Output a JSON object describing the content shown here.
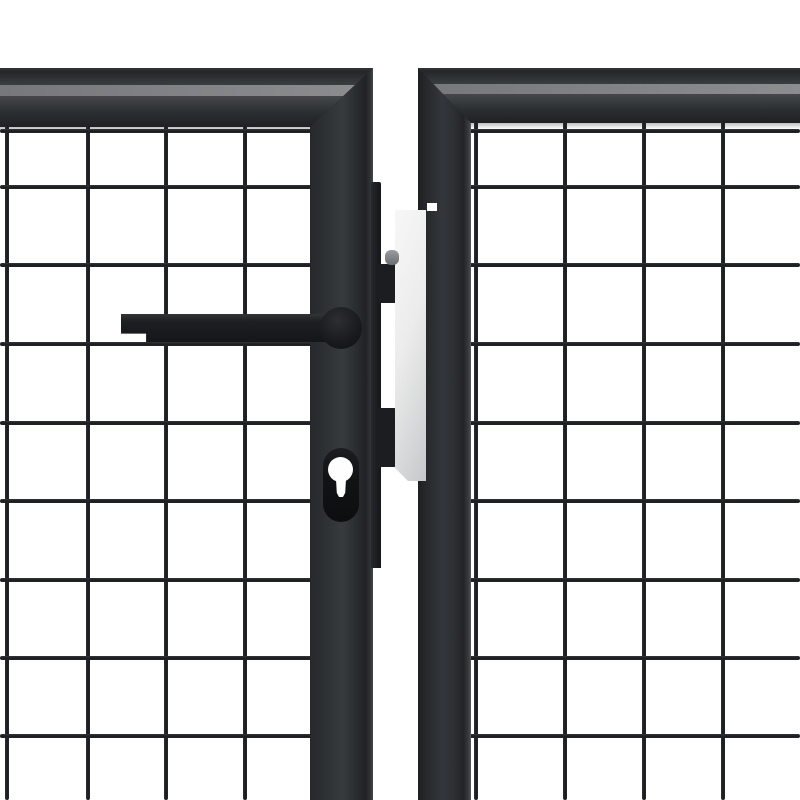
{
  "scene": {
    "description": "Product photograph of an anthracite steel mesh garden gate, close-up of the double-door centre with lever handle, euro-cylinder keyhole, latch hardware and galvanized strike plate on a white background",
    "background_color": "#ffffff",
    "width": 800,
    "height": 800
  },
  "colors": {
    "background": "#ffffff",
    "frame_dark": "#222427",
    "frame_mid": "#2e3134",
    "frame_bevel_light": "#85878a",
    "wire_dark": "#1e2124",
    "hardware_black": "#15171a",
    "plate_light": "#f6f6f6",
    "plate_dark": "#c7c8c9",
    "bolt_gray": "#8b8e90"
  },
  "panels": {
    "left": {
      "rail": {
        "x": 0,
        "y": 68,
        "w": 373,
        "h": 59
      },
      "rail_shadow": {
        "x": 0,
        "y": 127,
        "w": 314,
        "h": 6
      },
      "stile": {
        "x": 310,
        "y": 68,
        "w": 63,
        "h": 732
      },
      "mesh": {
        "wire_px": 4.5,
        "vertical_x": [
          7,
          88,
          166,
          245
        ],
        "horizontal_y": [
          131,
          187,
          265,
          344,
          423,
          501,
          580,
          658,
          736
        ],
        "h_x0": 0,
        "h_x1": 314,
        "v_y0": 125,
        "v_y1": 800
      }
    },
    "right": {
      "rail": {
        "x": 418,
        "y": 68,
        "w": 382,
        "h": 55
      },
      "rail_shadow": {
        "x": 467,
        "y": 123,
        "w": 333,
        "h": 6
      },
      "stile": {
        "x": 418,
        "y": 68,
        "w": 53,
        "h": 732
      },
      "stile_notch": {
        "x": 427,
        "y": 203,
        "w": 10,
        "h": 8
      },
      "mesh": {
        "wire_px": 4.5,
        "vertical_x": [
          476,
          565,
          644,
          723
        ],
        "horizontal_y": [
          131,
          187,
          265,
          344,
          423,
          501,
          580,
          658,
          736
        ],
        "h_x0": 467,
        "h_x1": 800,
        "v_y0": 121,
        "v_y1": 800
      }
    }
  },
  "hardware": {
    "latch_bar": {
      "x": 371,
      "y": 182,
      "w": 10,
      "h": 386
    },
    "latch_tab_upper": {
      "x": 376,
      "y": 264,
      "w": 22,
      "h": 39
    },
    "latch_tab_lower": {
      "x": 376,
      "y": 408,
      "w": 20,
      "h": 59
    },
    "strike_plate": {
      "x": 395,
      "y": 210,
      "w": 31,
      "h": 271
    },
    "latch_bolt": {
      "x": 385,
      "y": 250,
      "w": 14,
      "h": 15
    },
    "handle_bar": {
      "x": 121,
      "y": 314,
      "w": 224,
      "h": 28
    },
    "handle_hub": {
      "x": 320,
      "y": 307,
      "w": 42,
      "h": 42
    },
    "escutcheon": {
      "x": 323,
      "y": 448,
      "w": 36,
      "h": 74
    },
    "keyhole_circle": {
      "x": 328,
      "y": 457,
      "w": 25,
      "h": 25
    },
    "keyhole_stem": {
      "x": 334,
      "y": 474,
      "w": 14,
      "h": 23
    }
  }
}
